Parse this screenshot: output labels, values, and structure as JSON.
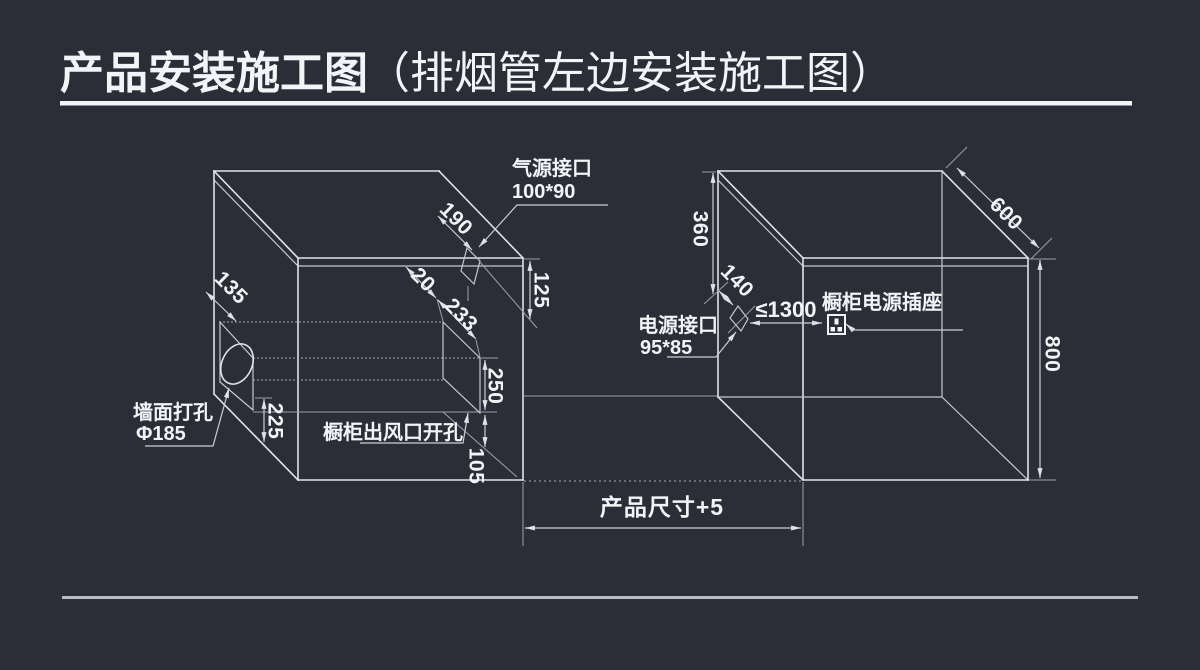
{
  "title": {
    "main": "产品安装施工图",
    "paren": "（排烟管左边安装施工图）"
  },
  "left_figure": {
    "gas_port": {
      "line1": "气源接口",
      "line2": "100*90"
    },
    "wall_hole": {
      "line1": "墙面打孔",
      "line2": "Φ185"
    },
    "vent_label": "橱柜出风口开孔",
    "dims": {
      "d190": "190",
      "d125": "125",
      "d20": "20",
      "d233": "233",
      "d135": "135",
      "d225": "225",
      "d250": "250",
      "d105": "105"
    }
  },
  "right_figure": {
    "power_port": {
      "line1": "电源接口",
      "line2": "95*85"
    },
    "socket_label": "橱柜电源插座",
    "dims": {
      "d360": "360",
      "d140": "140",
      "d1300": "≤1300",
      "d600": "600",
      "d800": "800"
    }
  },
  "bottom_dim": {
    "label": "产品尺寸+5"
  },
  "icons": {
    "socket": "power-socket-icon"
  },
  "colors": {
    "background": "#2b2d37",
    "edge_line": "#dfe3ea",
    "dim_line": "#c9ced8",
    "text": "#f2f4f7",
    "title_underline": "#f2f4f7",
    "footer_line": "#b7bbc3"
  }
}
